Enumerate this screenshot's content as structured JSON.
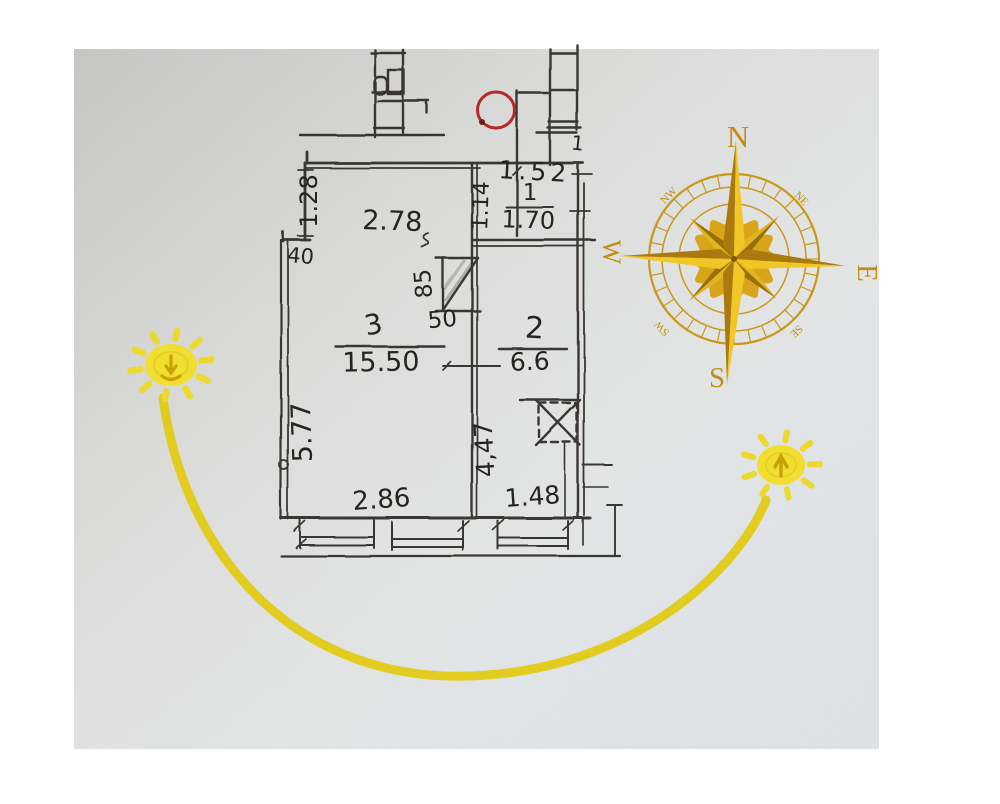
{
  "document": {
    "kind": "hand-drawn apartment floor plan photo with compass rose and sun path"
  },
  "labels": {
    "dim_1_28": "1.28",
    "dim_2_78": "2.78",
    "dim_1_52": "1.52",
    "dim_1_14": "1.14",
    "room1_no": "1",
    "room1_area": "1.70",
    "dim_40": "40",
    "dim_85": "85",
    "dim_50": "50",
    "room3_no": "3",
    "room3_area": "15.50",
    "room2_no": "2",
    "room2_area": "6.6",
    "dim_5_77": "5.77",
    "dim_4_47": "4,47",
    "dim_2_86": "2.86",
    "dim_1_48": "1.48",
    "mark_1": "1"
  },
  "compass": {
    "n": "N",
    "e": "E",
    "s": "S",
    "w": "W",
    "nw": "NW",
    "ne": "NE",
    "sw": "SW",
    "se": "SE"
  },
  "colors": {
    "ink": "#2e2c27",
    "marker_red": "#b52a27",
    "compass_gold": "#c9981b",
    "spike_light": "#f1c627",
    "spike_dark": "#aa7a0e",
    "sun_yellow": "#f2de30",
    "arc_yellow": "#e2ca15",
    "paper": "#d8dadb"
  }
}
